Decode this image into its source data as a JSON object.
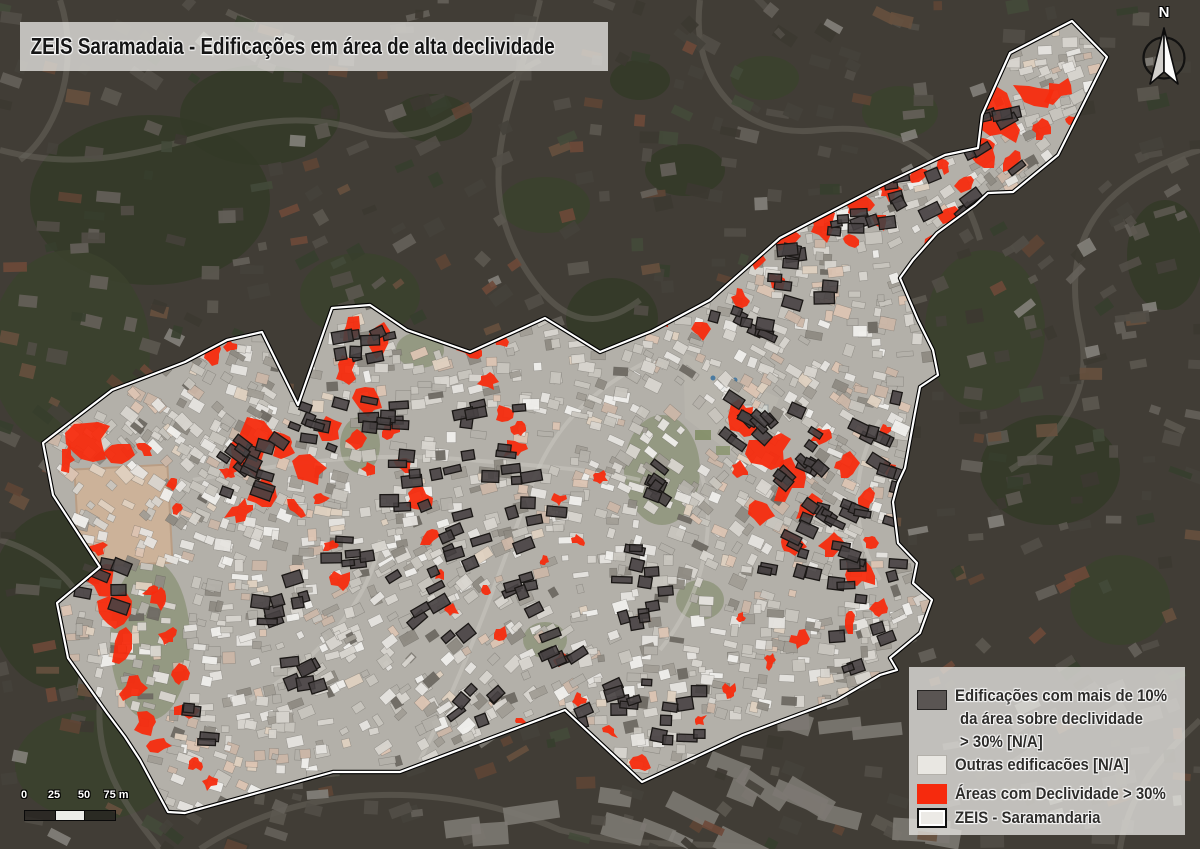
{
  "title": "ZEIS Saramadaia - Edificações em área de alta declividade",
  "north_arrow": {
    "label": "N"
  },
  "scale_bar": {
    "tick_labels": [
      "0",
      "25",
      "50",
      "75 m"
    ]
  },
  "legend": {
    "items": [
      {
        "id": "dark-buildings",
        "lines": [
          "Edificações com mais de 10%",
          "da área sobre declividade",
          "> 30% [N/A]"
        ]
      },
      {
        "id": "other-buildings",
        "lines": [
          "Outras edificacões [N/A]"
        ]
      },
      {
        "id": "steep-areas",
        "lines": [
          "Áreas com Declividade > 30%"
        ]
      },
      {
        "id": "zeis-boundary",
        "lines": [
          "ZEIS - Saramandaria"
        ]
      }
    ]
  },
  "colors": {
    "slope_red": "#f62a0d",
    "dark_building": "#474142",
    "dark_building_stroke": "#1b1816",
    "inside_base": "#b3b0a9",
    "outside_base": "#545047",
    "boundary_white": "#ffffff",
    "boundary_black": "#000000",
    "panel_bg": "rgba(230,228,224,0.78)",
    "title_text": "#151515",
    "legend_text": "#2d2c2a",
    "swatch_dark": "#5a5553",
    "swatch_dark_border": "#262423",
    "swatch_light": "#e9e7e2",
    "swatch_light_border": "#b3b0aa",
    "swatch_outline_bg": "#eceae6",
    "swatch_outline_border": "#0f0f0f",
    "scalebar_dark": "rgba(38,35,32,0.75)",
    "scalebar_light": "rgba(246,245,243,0.95)",
    "field_tan": "#ccb299",
    "veg_outside": "#3f4a31",
    "veg_outside2": "#4a5639",
    "veg_inside": "#76825c"
  },
  "map": {
    "boundary_points": [
      [
        43,
        443
      ],
      [
        112,
        390
      ],
      [
        185,
        362
      ],
      [
        227,
        340
      ],
      [
        262,
        332
      ],
      [
        298,
        405
      ],
      [
        332,
        308
      ],
      [
        370,
        305
      ],
      [
        407,
        330
      ],
      [
        470,
        352
      ],
      [
        545,
        318
      ],
      [
        600,
        352
      ],
      [
        652,
        331
      ],
      [
        710,
        300
      ],
      [
        780,
        238
      ],
      [
        880,
        186
      ],
      [
        945,
        155
      ],
      [
        978,
        148
      ],
      [
        982,
        115
      ],
      [
        1010,
        53
      ],
      [
        1072,
        21
      ],
      [
        1107,
        57
      ],
      [
        1058,
        155
      ],
      [
        1013,
        192
      ],
      [
        988,
        193
      ],
      [
        975,
        205
      ],
      [
        937,
        233
      ],
      [
        913,
        260
      ],
      [
        900,
        278
      ],
      [
        918,
        320
      ],
      [
        933,
        350
      ],
      [
        938,
        375
      ],
      [
        920,
        387
      ],
      [
        915,
        413
      ],
      [
        905,
        468
      ],
      [
        898,
        483
      ],
      [
        893,
        502
      ],
      [
        898,
        543
      ],
      [
        917,
        563
      ],
      [
        913,
        583
      ],
      [
        932,
        600
      ],
      [
        920,
        633
      ],
      [
        890,
        658
      ],
      [
        897,
        670
      ],
      [
        880,
        675
      ],
      [
        837,
        700
      ],
      [
        743,
        735
      ],
      [
        642,
        782
      ],
      [
        565,
        710
      ],
      [
        400,
        772
      ],
      [
        333,
        772
      ],
      [
        185,
        813
      ],
      [
        168,
        812
      ],
      [
        140,
        760
      ],
      [
        125,
        737
      ],
      [
        107,
        713
      ],
      [
        68,
        658
      ],
      [
        57,
        603
      ],
      [
        100,
        567
      ],
      [
        53,
        495
      ]
    ],
    "red_blobs": [
      [
        90,
        441,
        15
      ],
      [
        118,
        452,
        11
      ],
      [
        68,
        459,
        8
      ],
      [
        145,
        449,
        7
      ],
      [
        173,
        484,
        6
      ],
      [
        177,
        510,
        6
      ],
      [
        97,
        549,
        8
      ],
      [
        104,
        577,
        12
      ],
      [
        113,
        611,
        13
      ],
      [
        121,
        647,
        14
      ],
      [
        133,
        689,
        13
      ],
      [
        147,
        724,
        11
      ],
      [
        160,
        745,
        7
      ],
      [
        160,
        598,
        7
      ],
      [
        169,
        637,
        8
      ],
      [
        178,
        676,
        8
      ],
      [
        186,
        711,
        7
      ],
      [
        150,
        592,
        6
      ],
      [
        196,
        764,
        6
      ],
      [
        210,
        782,
        5
      ],
      [
        250,
        452,
        16
      ],
      [
        283,
        446,
        13
      ],
      [
        309,
        470,
        11
      ],
      [
        264,
        491,
        11
      ],
      [
        241,
        511,
        9
      ],
      [
        296,
        509,
        8
      ],
      [
        321,
        499,
        7
      ],
      [
        331,
        430,
        7
      ],
      [
        228,
        474,
        8
      ],
      [
        213,
        354,
        6
      ],
      [
        231,
        346,
        5
      ],
      [
        353,
        331,
        12
      ],
      [
        378,
        341,
        11
      ],
      [
        346,
        371,
        9
      ],
      [
        369,
        401,
        10
      ],
      [
        390,
        431,
        9
      ],
      [
        404,
        464,
        9
      ],
      [
        419,
        499,
        8
      ],
      [
        430,
        539,
        7
      ],
      [
        441,
        576,
        7
      ],
      [
        452,
        610,
        6
      ],
      [
        331,
        546,
        7
      ],
      [
        341,
        581,
        6
      ],
      [
        357,
        440,
        8
      ],
      [
        370,
        470,
        7
      ],
      [
        469,
        351,
        9
      ],
      [
        489,
        381,
        8
      ],
      [
        504,
        414,
        8
      ],
      [
        515,
        449,
        7
      ],
      [
        481,
        331,
        6
      ],
      [
        500,
        340,
        6
      ],
      [
        559,
        500,
        6
      ],
      [
        579,
        541,
        5
      ],
      [
        600,
        478,
        5
      ],
      [
        545,
        562,
        5
      ],
      [
        520,
        430,
        5
      ],
      [
        579,
        700,
        6
      ],
      [
        609,
        731,
        6
      ],
      [
        641,
        762,
        7
      ],
      [
        668,
        792,
        6
      ],
      [
        700,
        721,
        5
      ],
      [
        731,
        692,
        5
      ],
      [
        561,
        661,
        5
      ],
      [
        521,
        721,
        4
      ],
      [
        487,
        591,
        6
      ],
      [
        501,
        634,
        5
      ],
      [
        744,
        421,
        13
      ],
      [
        769,
        450,
        12
      ],
      [
        789,
        479,
        12
      ],
      [
        809,
        509,
        11
      ],
      [
        834,
        544,
        11
      ],
      [
        859,
        574,
        10
      ],
      [
        871,
        541,
        8
      ],
      [
        866,
        501,
        8
      ],
      [
        846,
        466,
        8
      ],
      [
        821,
        436,
        8
      ],
      [
        791,
        544,
        9
      ],
      [
        762,
        511,
        8
      ],
      [
        741,
        470,
        7
      ],
      [
        879,
        609,
        7
      ],
      [
        851,
        621,
        7
      ],
      [
        884,
        431,
        6
      ],
      [
        889,
        469,
        5
      ],
      [
        801,
        641,
        6
      ],
      [
        771,
        661,
        5
      ],
      [
        741,
        619,
        5
      ],
      [
        659,
        321,
        8
      ],
      [
        689,
        301,
        9
      ],
      [
        719,
        276,
        10
      ],
      [
        754,
        256,
        11
      ],
      [
        789,
        241,
        11
      ],
      [
        824,
        226,
        10
      ],
      [
        859,
        206,
        9
      ],
      [
        889,
        191,
        8
      ],
      [
        919,
        176,
        8
      ],
      [
        944,
        166,
        7
      ],
      [
        741,
        301,
        8
      ],
      [
        779,
        281,
        8
      ],
      [
        701,
        331,
        7
      ],
      [
        851,
        241,
        7
      ],
      [
        881,
        221,
        7
      ],
      [
        999,
        116,
        18
      ],
      [
        1034,
        96,
        13
      ],
      [
        1059,
        91,
        9
      ],
      [
        986,
        151,
        11
      ],
      [
        966,
        186,
        9
      ],
      [
        951,
        216,
        8
      ],
      [
        936,
        246,
        7
      ],
      [
        1074,
        121,
        7
      ],
      [
        1011,
        161,
        8
      ],
      [
        1041,
        131,
        8
      ]
    ],
    "dark_clusters": [
      [
        100,
        580,
        9
      ],
      [
        250,
        462,
        13
      ],
      [
        302,
        432,
        9
      ],
      [
        356,
        341,
        9
      ],
      [
        386,
        421,
        9
      ],
      [
        421,
        476,
        9
      ],
      [
        446,
        546,
        8
      ],
      [
        351,
        566,
        7
      ],
      [
        286,
        606,
        8
      ],
      [
        521,
        601,
        6
      ],
      [
        561,
        651,
        6
      ],
      [
        616,
        691,
        7
      ],
      [
        676,
        716,
        8
      ],
      [
        736,
        756,
        6
      ],
      [
        621,
        561,
        6
      ],
      [
        656,
        481,
        6
      ],
      [
        756,
        426,
        11
      ],
      [
        796,
        466,
        11
      ],
      [
        831,
        521,
        9
      ],
      [
        856,
        576,
        9
      ],
      [
        801,
        556,
        8
      ],
      [
        746,
        321,
        8
      ],
      [
        801,
        271,
        9
      ],
      [
        856,
        221,
        8
      ],
      [
        916,
        191,
        6
      ],
      [
        1001,
        141,
        8
      ],
      [
        876,
        426,
        6
      ],
      [
        881,
        481,
        6
      ],
      [
        301,
        681,
        6
      ],
      [
        206,
        731,
        4
      ],
      [
        426,
        621,
        6
      ],
      [
        481,
        701,
        6
      ],
      [
        556,
        726,
        6
      ],
      [
        641,
        621,
        6
      ],
      [
        901,
        541,
        5
      ],
      [
        861,
        641,
        5
      ],
      [
        481,
        421,
        7
      ],
      [
        511,
        471,
        6
      ],
      [
        541,
        521,
        5
      ],
      [
        971,
        201,
        5
      ],
      [
        931,
        261,
        4
      ]
    ],
    "green_out": [
      [
        150,
        200,
        120,
        85
      ],
      [
        70,
        350,
        80,
        100
      ],
      [
        260,
        115,
        80,
        50
      ],
      [
        360,
        295,
        60,
        42
      ],
      [
        612,
        318,
        46,
        40
      ],
      [
        985,
        330,
        60,
        80
      ],
      [
        1050,
        470,
        70,
        55
      ],
      [
        900,
        112,
        38,
        26
      ],
      [
        60,
        600,
        70,
        90
      ],
      [
        95,
        765,
        80,
        55
      ],
      [
        432,
        118,
        40,
        24
      ],
      [
        765,
        78,
        34,
        22
      ],
      [
        1165,
        255,
        38,
        55
      ],
      [
        545,
        205,
        45,
        28
      ],
      [
        685,
        170,
        40,
        26
      ],
      [
        1120,
        600,
        50,
        45
      ],
      [
        640,
        80,
        30,
        20
      ]
    ],
    "green_in": [
      [
        662,
        470,
        38,
        55
      ],
      [
        150,
        640,
        40,
        80
      ],
      [
        120,
        500,
        28,
        30
      ],
      [
        420,
        350,
        24,
        18
      ],
      [
        360,
        445,
        20,
        28
      ],
      [
        545,
        640,
        22,
        18
      ],
      [
        700,
        600,
        24,
        20
      ]
    ],
    "field": [
      77,
      467,
      93,
      98,
      -3
    ],
    "praca": [
      [
        683,
        352
      ],
      [
        779,
        398
      ],
      [
        750,
        468
      ],
      [
        685,
        418
      ]
    ]
  }
}
